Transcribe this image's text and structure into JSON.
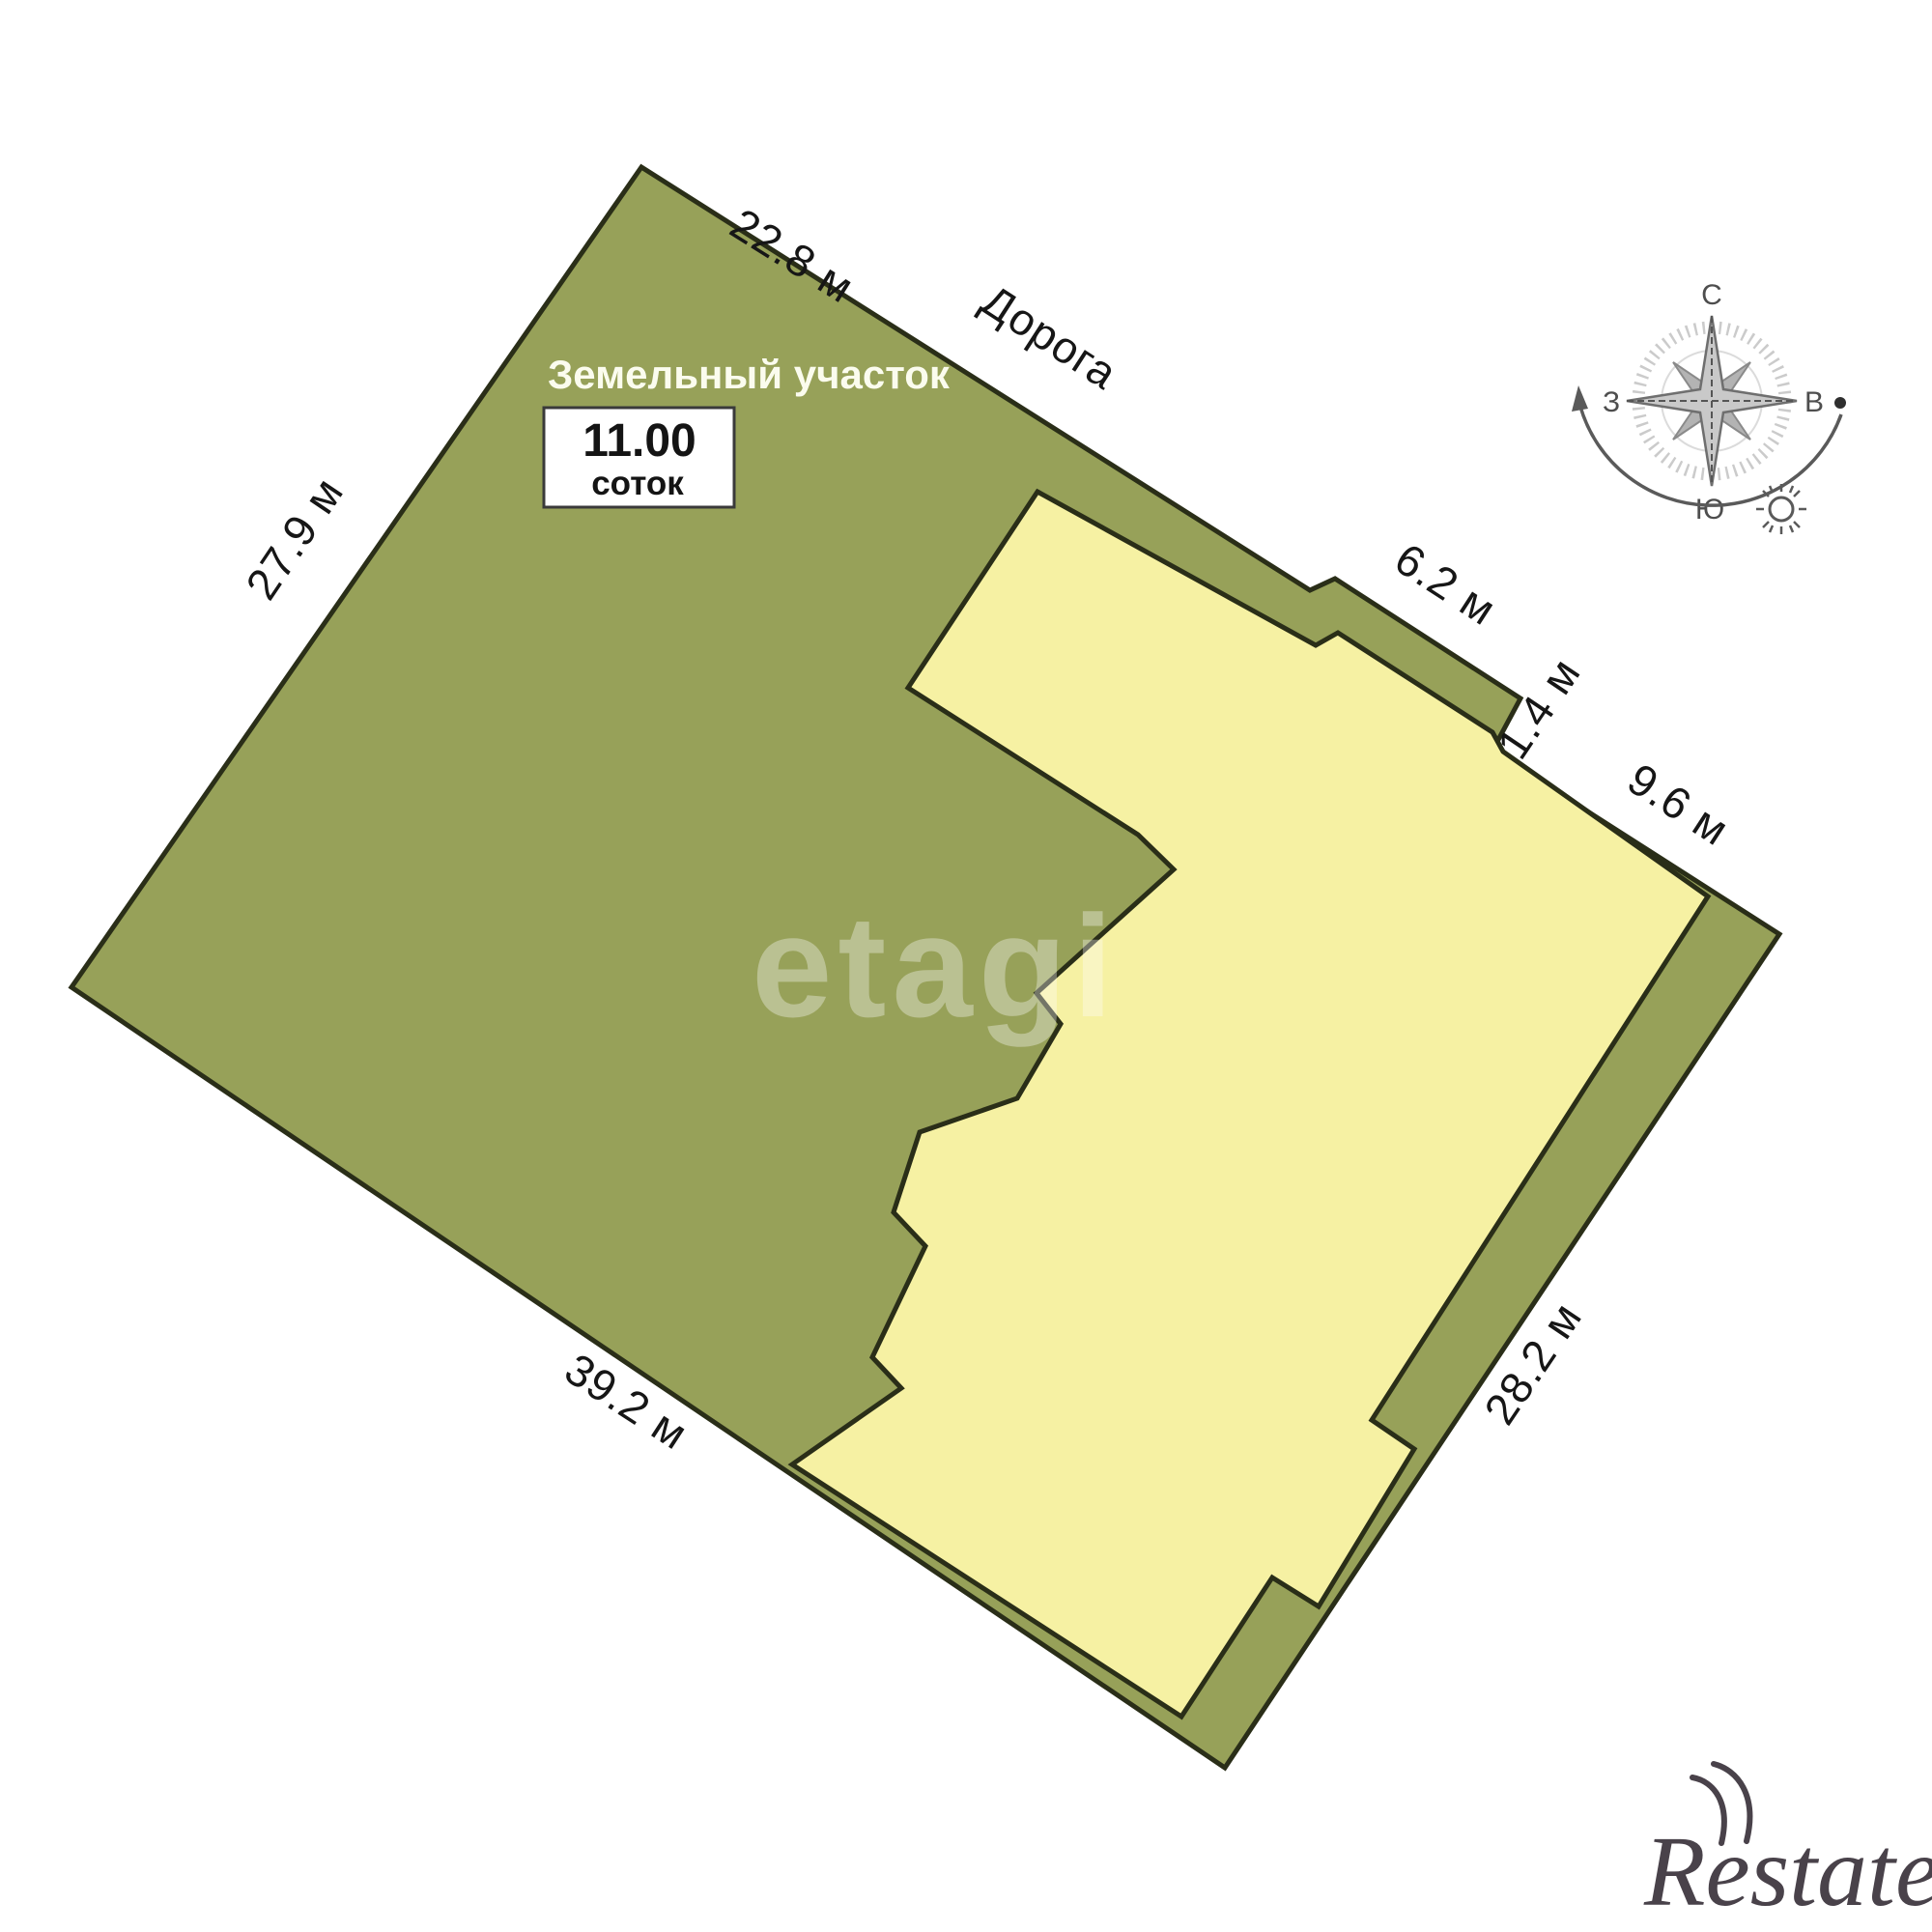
{
  "map": {
    "land_label": "Земельный участок",
    "area_value": "11.00",
    "area_unit": "соток",
    "road_label": "Дорога",
    "dims": {
      "top": "22.8 м",
      "left": "27.9 м",
      "bottom": "39.2 м",
      "right": "28.2 м",
      "road_edge": "6.2 м",
      "step": "1.4 м",
      "after_step": "9.6 м"
    },
    "colors": {
      "land": "#97a159",
      "building": "#f6f1a3",
      "outline": "#2a2e18",
      "dimension_text": "#161616",
      "label_text": "#fbfcee"
    }
  },
  "compass": {
    "north": "С",
    "south": "Ю",
    "west": "З",
    "east": "В"
  },
  "watermarks": {
    "center": "etagi",
    "bottom": "циан",
    "corner": "Restate"
  }
}
